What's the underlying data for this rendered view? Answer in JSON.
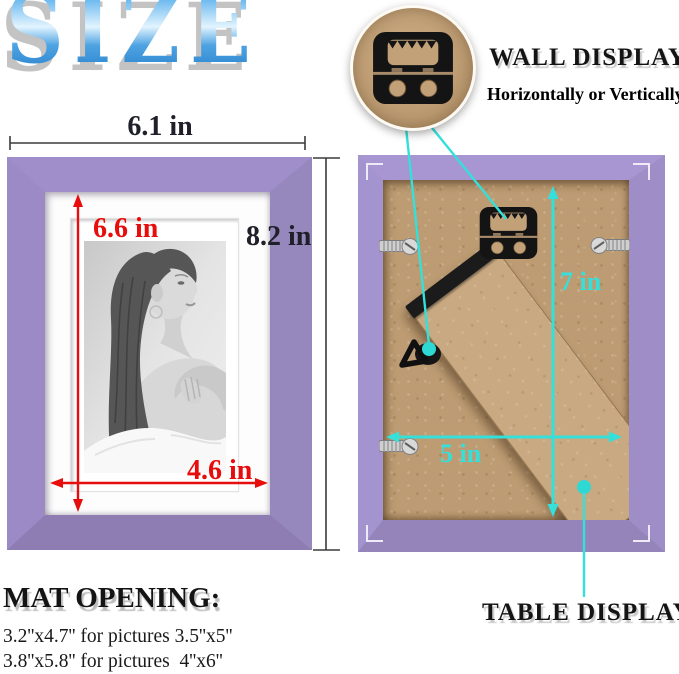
{
  "title": {
    "text": "SIZE"
  },
  "front_view": {
    "width": "6.1 in",
    "height": "8.2 in",
    "opening_height": "6.6 in",
    "opening_width": "4.6 in"
  },
  "back_view": {
    "height": "7 in",
    "width": "5 in"
  },
  "wall_display": {
    "title": "WALL DISPLAY",
    "subtitle": "Horizontally or Vertically"
  },
  "table_display": {
    "title": "TABLE DISPLAY"
  },
  "mat_opening": {
    "heading": "MAT OPENING:",
    "line1": "3.2''x4.7'' for pictures 3.5''x5''",
    "line2": "3.8''x5.8'' for pictures  4''x6''"
  },
  "icons": {
    "sawtooth_hanger": "sawtooth-hanger-icon",
    "d_ring_hanger": "d-ring-hanger-icon",
    "turn_button_clip": "turn-button-clip-icon",
    "corner_bracket": "corner-bracket-icon",
    "easel_stand": "easel-stand"
  },
  "colors": {
    "frame_purple": "#9a89c3",
    "backing_tan": "#bd9c73",
    "dimension_red": "#e70d0d",
    "dimension_cyan": "#35dfda",
    "title_blue": "#2d96e0",
    "mat_white": "#fdfdfd"
  }
}
